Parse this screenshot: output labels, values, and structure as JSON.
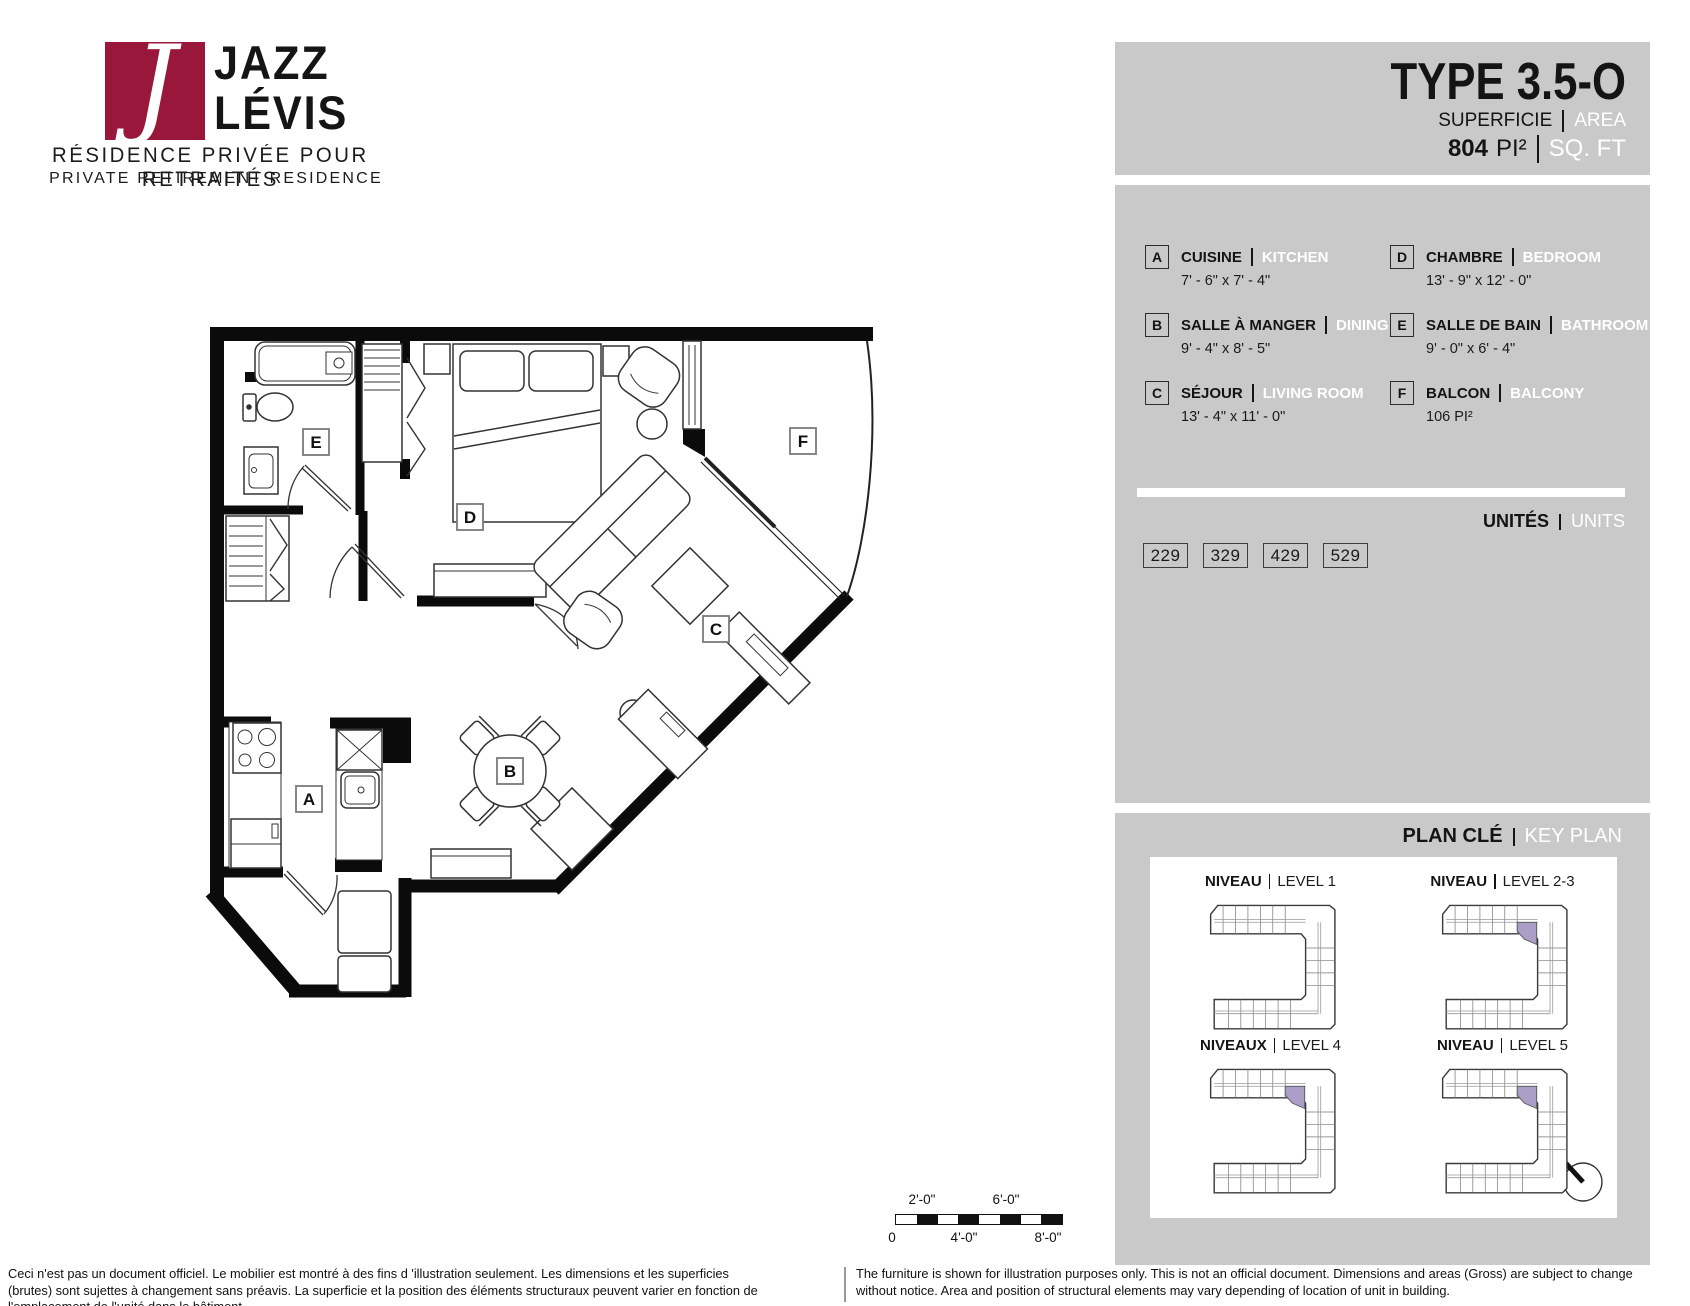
{
  "logo": {
    "monogram": "J",
    "name_line1": "JAZZ",
    "name_line2": "LÉVIS",
    "tagline_fr": "RÉSIDENCE PRIVÉE POUR RETRAITÉS",
    "tagline_en": "PRIVATE RETIREMENT RESIDENCE",
    "brand_color": "#99173a"
  },
  "header": {
    "type_label": "TYPE  3.5-O",
    "superficie_label": "SUPERFICIE",
    "area_label": "AREA",
    "area_value": "804",
    "area_unit_fr": "PI²",
    "area_unit_en": "SQ. FT"
  },
  "legend": {
    "items": [
      {
        "key": "A",
        "name_fr": "CUISINE",
        "name_en": "KITCHEN",
        "dims": "7' - 6\" x 7' - 4\""
      },
      {
        "key": "B",
        "name_fr": "SALLE À MANGER",
        "name_en": "DINING",
        "dims": "9' - 4\" x 8' - 5\""
      },
      {
        "key": "C",
        "name_fr": "SÉJOUR",
        "name_en": "LIVING ROOM",
        "dims": "13' - 4\" x 11' - 0\""
      },
      {
        "key": "D",
        "name_fr": "CHAMBRE",
        "name_en": "BEDROOM",
        "dims": "13' - 9\" x 12' - 0\""
      },
      {
        "key": "E",
        "name_fr": "SALLE DE BAIN",
        "name_en": "BATHROOM",
        "dims": "9' - 0\" x 6' - 4\""
      },
      {
        "key": "F",
        "name_fr": "BALCON",
        "name_en": "BALCONY",
        "dims": "106 PI²"
      }
    ]
  },
  "units": {
    "title_fr": "UNITÉS",
    "title_en": "UNITS",
    "numbers": [
      "229",
      "329",
      "429",
      "529"
    ]
  },
  "key_plan": {
    "title_fr": "PLAN CLÉ",
    "title_en": "KEY PLAN",
    "highlight_color": "#ab9ec7",
    "north_label": "N",
    "levels": [
      {
        "label_fr": "NIVEAU",
        "label_en": "LEVEL 1",
        "highlight": false
      },
      {
        "label_fr": "NIVEAU",
        "label_en": "LEVEL 2-3",
        "highlight": true
      },
      {
        "label_fr": "NIVEAUX",
        "label_en": "LEVEL 4",
        "highlight": true
      },
      {
        "label_fr": "NIVEAU",
        "label_en": "LEVEL 5",
        "highlight": true
      }
    ]
  },
  "floor_plan": {
    "room_labels": [
      {
        "key": "A",
        "x": 309,
        "y": 799
      },
      {
        "key": "B",
        "x": 510,
        "y": 771
      },
      {
        "key": "C",
        "x": 716,
        "y": 629
      },
      {
        "key": "D",
        "x": 470,
        "y": 517
      },
      {
        "key": "E",
        "x": 316,
        "y": 442
      },
      {
        "key": "F",
        "x": 803,
        "y": 441
      }
    ]
  },
  "scale_bar": {
    "top_labels": [
      "2'-0\"",
      "6'-0\""
    ],
    "bottom_labels": [
      "0",
      "4'-0\"",
      "8'-0\""
    ]
  },
  "disclaimer": {
    "fr": "Ceci n'est pas un document officiel.  Le mobilier est montré à des fins d 'illustration seulement.  Les dimensions et les superficies (brutes) sont sujettes à changement sans préavis. La superficie et la position des éléments structuraux peuvent varier en fonction de l'emplacement de l'unité dans le bâtiment.",
    "en": "The furniture is shown for illustration purposes only.  This is not an official document.  Dimensions and areas (Gross) are subject to change without notice. Area and position of structural elements may vary depending of location of unit in building."
  }
}
